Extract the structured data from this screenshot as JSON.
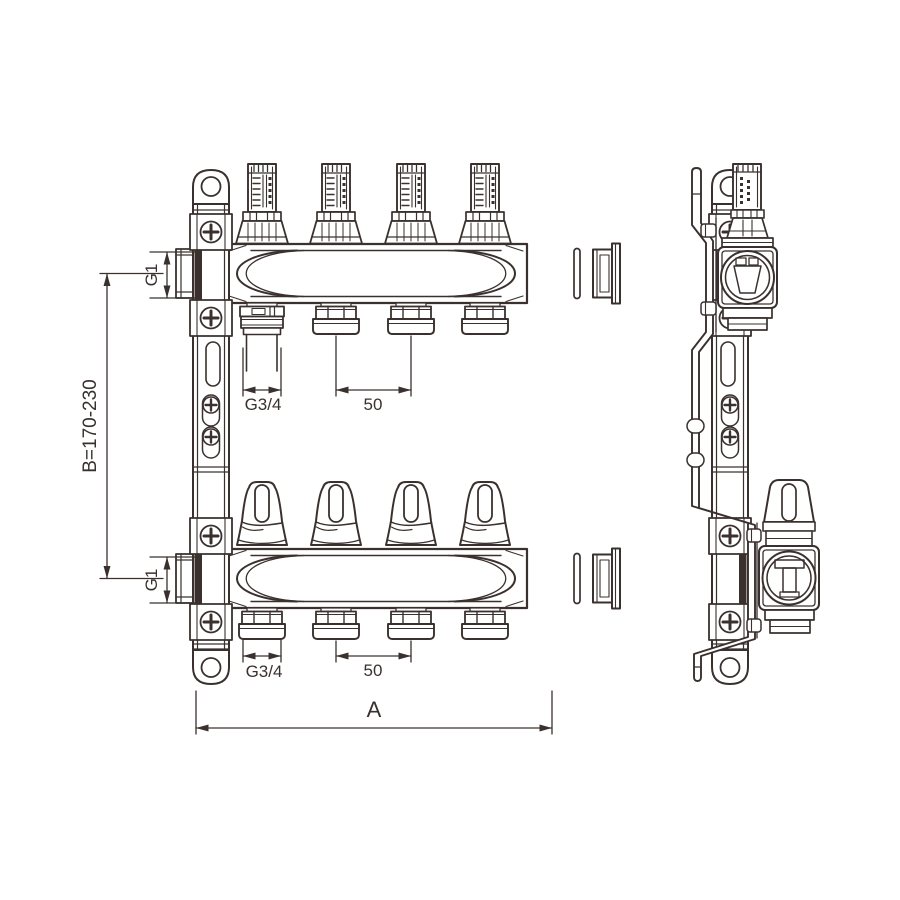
{
  "drawing": {
    "subject": "Brass floor-heating manifold with flow meters and valve caps, front view and side view",
    "line_color": "#3a312e",
    "background_color": "#ffffff",
    "dimensions": {
      "left_port_top": "G1",
      "left_port_bottom": "G1",
      "center_distance": "B=170-230",
      "outlet_thread_top": "G3/4",
      "outlet_spacing_top": "50",
      "outlet_thread_bottom": "G3/4",
      "outlet_spacing_bottom": "50",
      "overall_width": "A"
    }
  }
}
